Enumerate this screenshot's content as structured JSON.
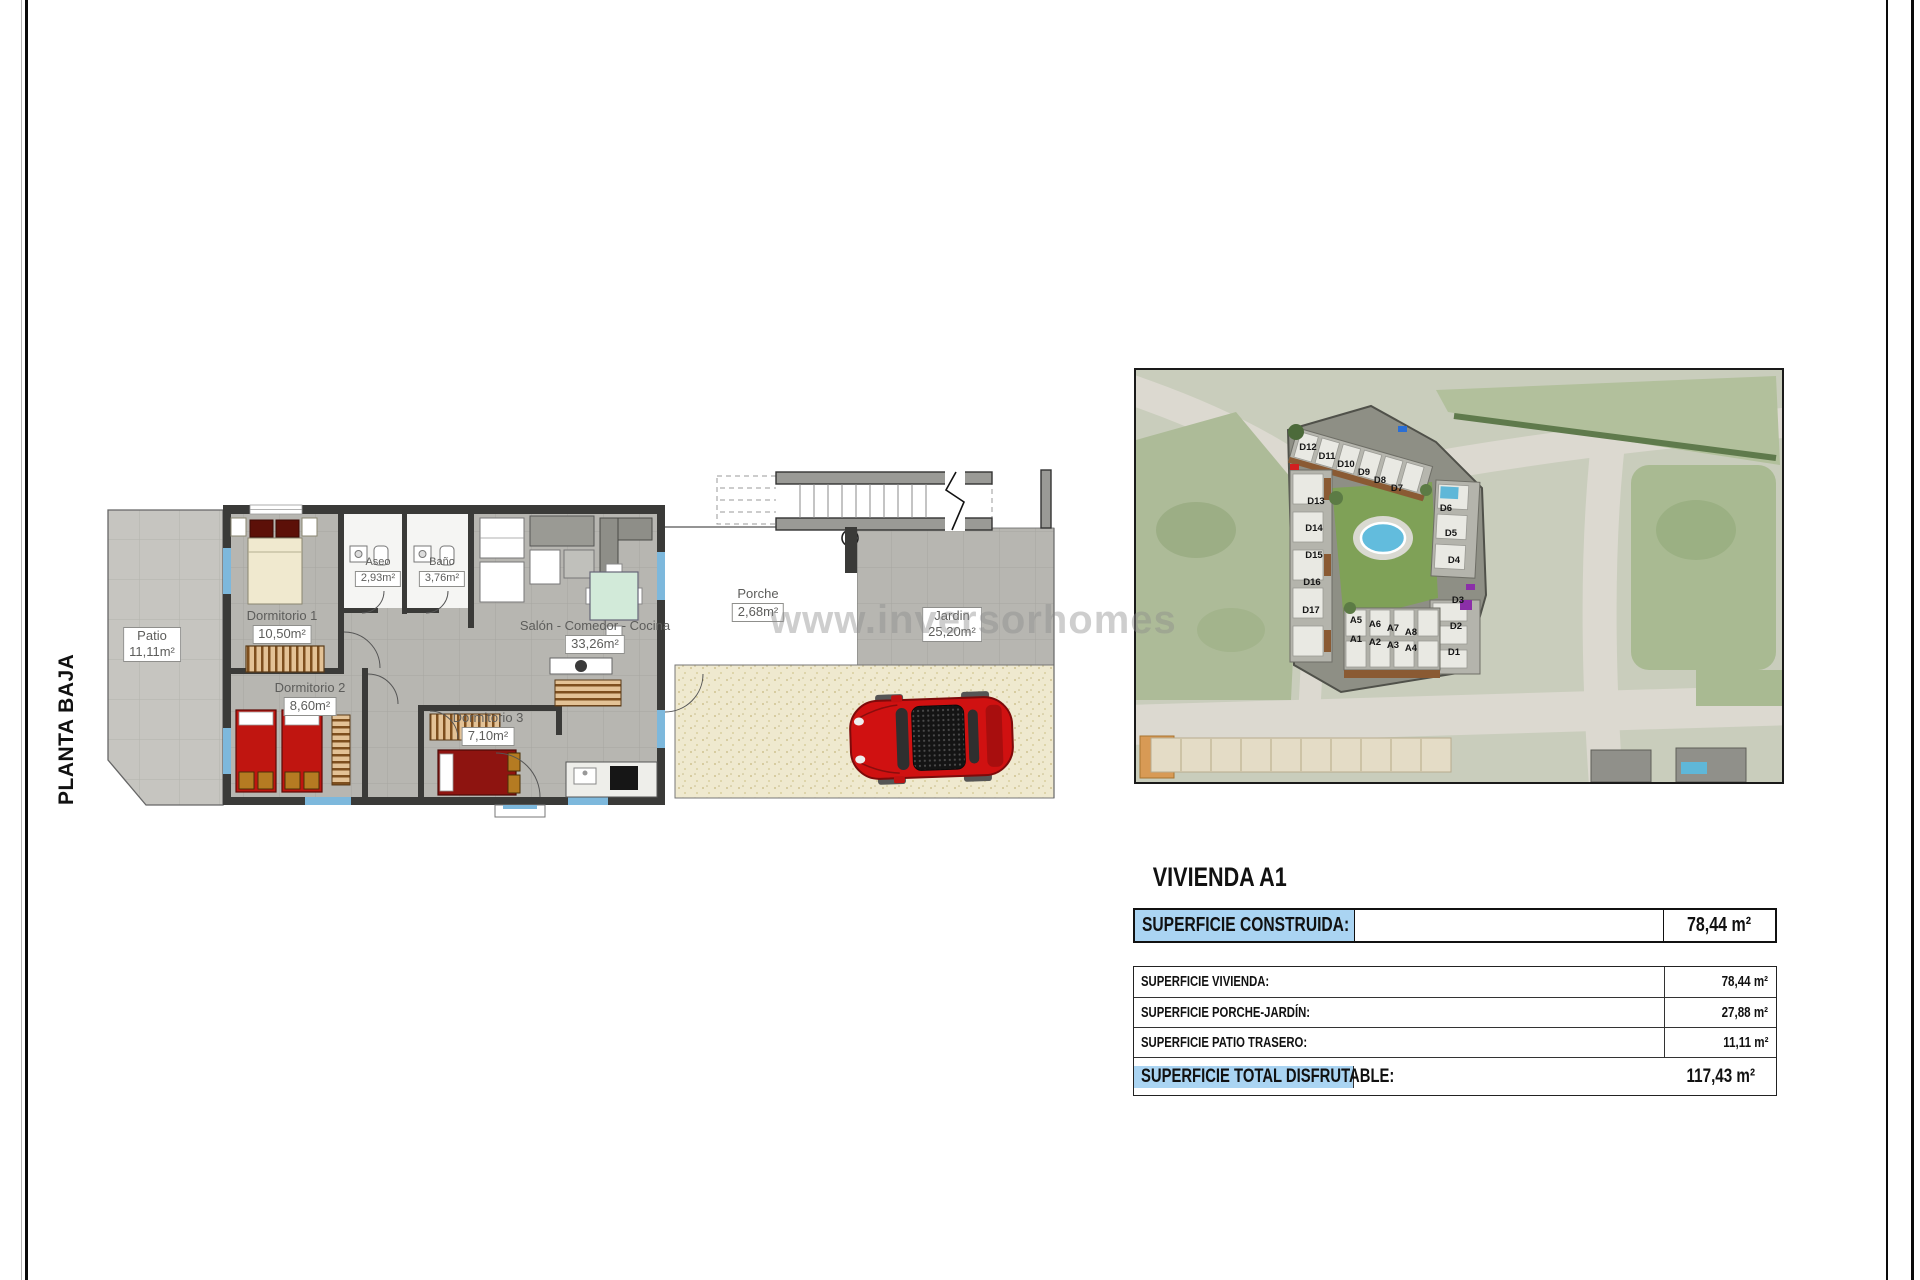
{
  "sheet": {
    "floor_label": "PLANTA BAJA",
    "watermark": "www.inversorhomes"
  },
  "floor_plan": {
    "rooms": [
      {
        "id": "patio",
        "name": "Patio",
        "area": "11,11m²",
        "cx": 52,
        "cy": 166,
        "boxed": "both",
        "small": false
      },
      {
        "id": "dormitorio-1",
        "name": "Dormitorio 1",
        "area": "10,50m²",
        "cx": 182,
        "cy": 148,
        "boxed": "area",
        "small": false
      },
      {
        "id": "aseo",
        "name": "Aseo",
        "area": "2,93m²",
        "cx": 278,
        "cy": 96,
        "boxed": "area",
        "small": true
      },
      {
        "id": "bano",
        "name": "Baño",
        "area": "3,76m²",
        "cx": 342,
        "cy": 96,
        "boxed": "area",
        "small": true
      },
      {
        "id": "salon",
        "name": "Salón - Comedor - Cocina",
        "area": "33,26m²",
        "cx": 495,
        "cy": 158,
        "boxed": "area",
        "small": false
      },
      {
        "id": "dormitorio-2",
        "name": "Dormitorio 2",
        "area": "8,60m²",
        "cx": 210,
        "cy": 220,
        "boxed": "area",
        "small": false
      },
      {
        "id": "dormitorio-3",
        "name": "Dormitorio 3",
        "area": "7,10m²",
        "cx": 388,
        "cy": 250,
        "boxed": "area",
        "small": false
      },
      {
        "id": "porche",
        "name": "Porche",
        "area": "2,68m²",
        "cx": 658,
        "cy": 126,
        "boxed": "area",
        "small": false
      },
      {
        "id": "jardin",
        "name": "Jardin",
        "area": "25,20m²",
        "cx": 852,
        "cy": 146,
        "boxed": "both",
        "small": false
      }
    ]
  },
  "site_plan": {
    "units": [
      {
        "label": "D12",
        "x": 172,
        "y": 80
      },
      {
        "label": "D11",
        "x": 191,
        "y": 89
      },
      {
        "label": "D10",
        "x": 210,
        "y": 97
      },
      {
        "label": "D9",
        "x": 228,
        "y": 105
      },
      {
        "label": "D8",
        "x": 244,
        "y": 113
      },
      {
        "label": "D7",
        "x": 261,
        "y": 121
      },
      {
        "label": "D13",
        "x": 180,
        "y": 134
      },
      {
        "label": "D14",
        "x": 178,
        "y": 161
      },
      {
        "label": "D15",
        "x": 178,
        "y": 188
      },
      {
        "label": "D16",
        "x": 176,
        "y": 215
      },
      {
        "label": "D17",
        "x": 175,
        "y": 243
      },
      {
        "label": "D6",
        "x": 310,
        "y": 141
      },
      {
        "label": "D5",
        "x": 315,
        "y": 166
      },
      {
        "label": "D4",
        "x": 318,
        "y": 193
      },
      {
        "label": "D3",
        "x": 322,
        "y": 233
      },
      {
        "label": "D2",
        "x": 320,
        "y": 259
      },
      {
        "label": "D1",
        "x": 318,
        "y": 285
      },
      {
        "label": "A5",
        "x": 220,
        "y": 253
      },
      {
        "label": "A6",
        "x": 239,
        "y": 257
      },
      {
        "label": "A7",
        "x": 257,
        "y": 261
      },
      {
        "label": "A8",
        "x": 275,
        "y": 265
      },
      {
        "label": "A1",
        "x": 220,
        "y": 272
      },
      {
        "label": "A2",
        "x": 239,
        "y": 275
      },
      {
        "label": "A3",
        "x": 257,
        "y": 278
      },
      {
        "label": "A4",
        "x": 275,
        "y": 281
      }
    ]
  },
  "summary": {
    "title": "VIVIENDA A1",
    "header_row": {
      "label": "SUPERFICIE CONSTRUIDA:",
      "value": "78,44 m²"
    },
    "rows": [
      {
        "label": "SUPERFICIE VIVIENDA:",
        "value": "78,44 m²"
      },
      {
        "label": "SUPERFICIE PORCHE-JARDÍN:",
        "value": "27,88 m²"
      },
      {
        "label": "SUPERFICIE PATIO TRASERO:",
        "value": "11,11 m²"
      }
    ],
    "total_row": {
      "label": "SUPERFICIE TOTAL DISFRUTABLE:",
      "value": "117,43 m²"
    }
  }
}
